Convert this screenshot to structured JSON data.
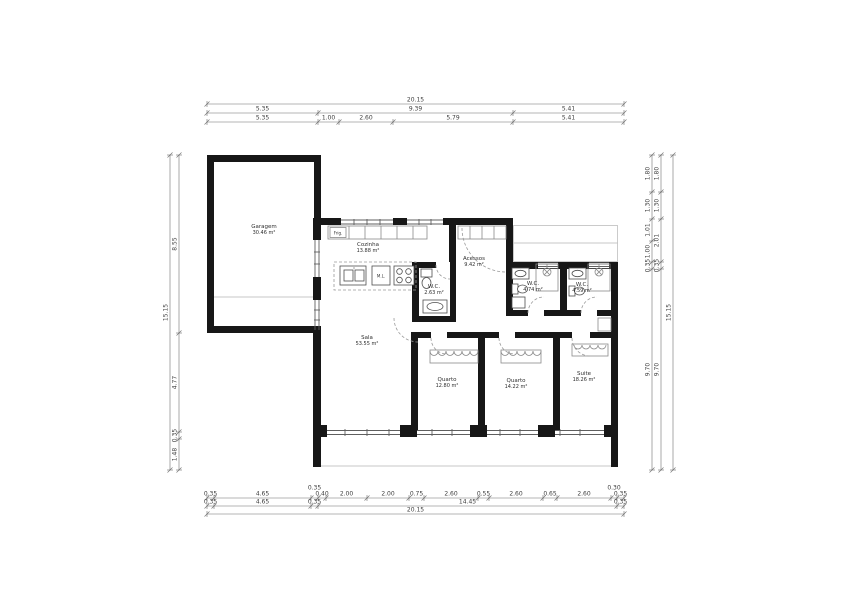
{
  "rooms": {
    "garagem": {
      "name": "Garagem",
      "area": "30.46 m²"
    },
    "cozinha": {
      "name": "Cozinha",
      "area": "13.88 m²"
    },
    "acessos": {
      "name": "Acessos",
      "area": "9.42 m²"
    },
    "wc1": {
      "name": "W.C.",
      "area": "2.63 m²"
    },
    "wc2": {
      "name": "W.C.",
      "area": "4.74 m²"
    },
    "wc3": {
      "name": "W.C.",
      "area": "4.59 m²"
    },
    "sala": {
      "name": "Sala",
      "area": "53.55 m²"
    },
    "quarto1": {
      "name": "Quarto",
      "area": "12.80 m²"
    },
    "quarto2": {
      "name": "Quarto",
      "area": "14.22 m²"
    },
    "suite": {
      "name": "Suite",
      "area": "18.26 m²"
    }
  },
  "appliances": {
    "fridge": "Frig.",
    "washer": "M.L."
  },
  "dimensions": {
    "top_row1": [
      "20.15"
    ],
    "top_row2": [
      "5.35",
      "9.39",
      "5.41"
    ],
    "top_row3": [
      "5.35",
      "1.00",
      "2.60",
      "5.79",
      "5.41"
    ],
    "bottom_row1": [
      "0.35",
      "4.65",
      "0.35",
      "0.40",
      "2.00",
      "2.00",
      "0.75",
      "2.60",
      "0.55",
      "2.60",
      "0.65",
      "2.60",
      "0.30",
      "0.35"
    ],
    "bottom_row2": [
      "0.35",
      "4.65",
      "0.35",
      "14.45",
      "0.35"
    ],
    "bottom_row3": [
      "20.15"
    ],
    "left_inner": [
      "8.55",
      "4.77",
      "0.35",
      "1.48"
    ],
    "left_outer": [
      "15.15"
    ],
    "right_col1": [
      "1.80",
      "1.30",
      "1.01",
      "1.00",
      "0.35",
      "9.70"
    ],
    "right_col2": [
      "1.80",
      "1.30",
      "2.01",
      "0.35",
      "9.70"
    ],
    "right_col3": [
      "15.15"
    ]
  }
}
